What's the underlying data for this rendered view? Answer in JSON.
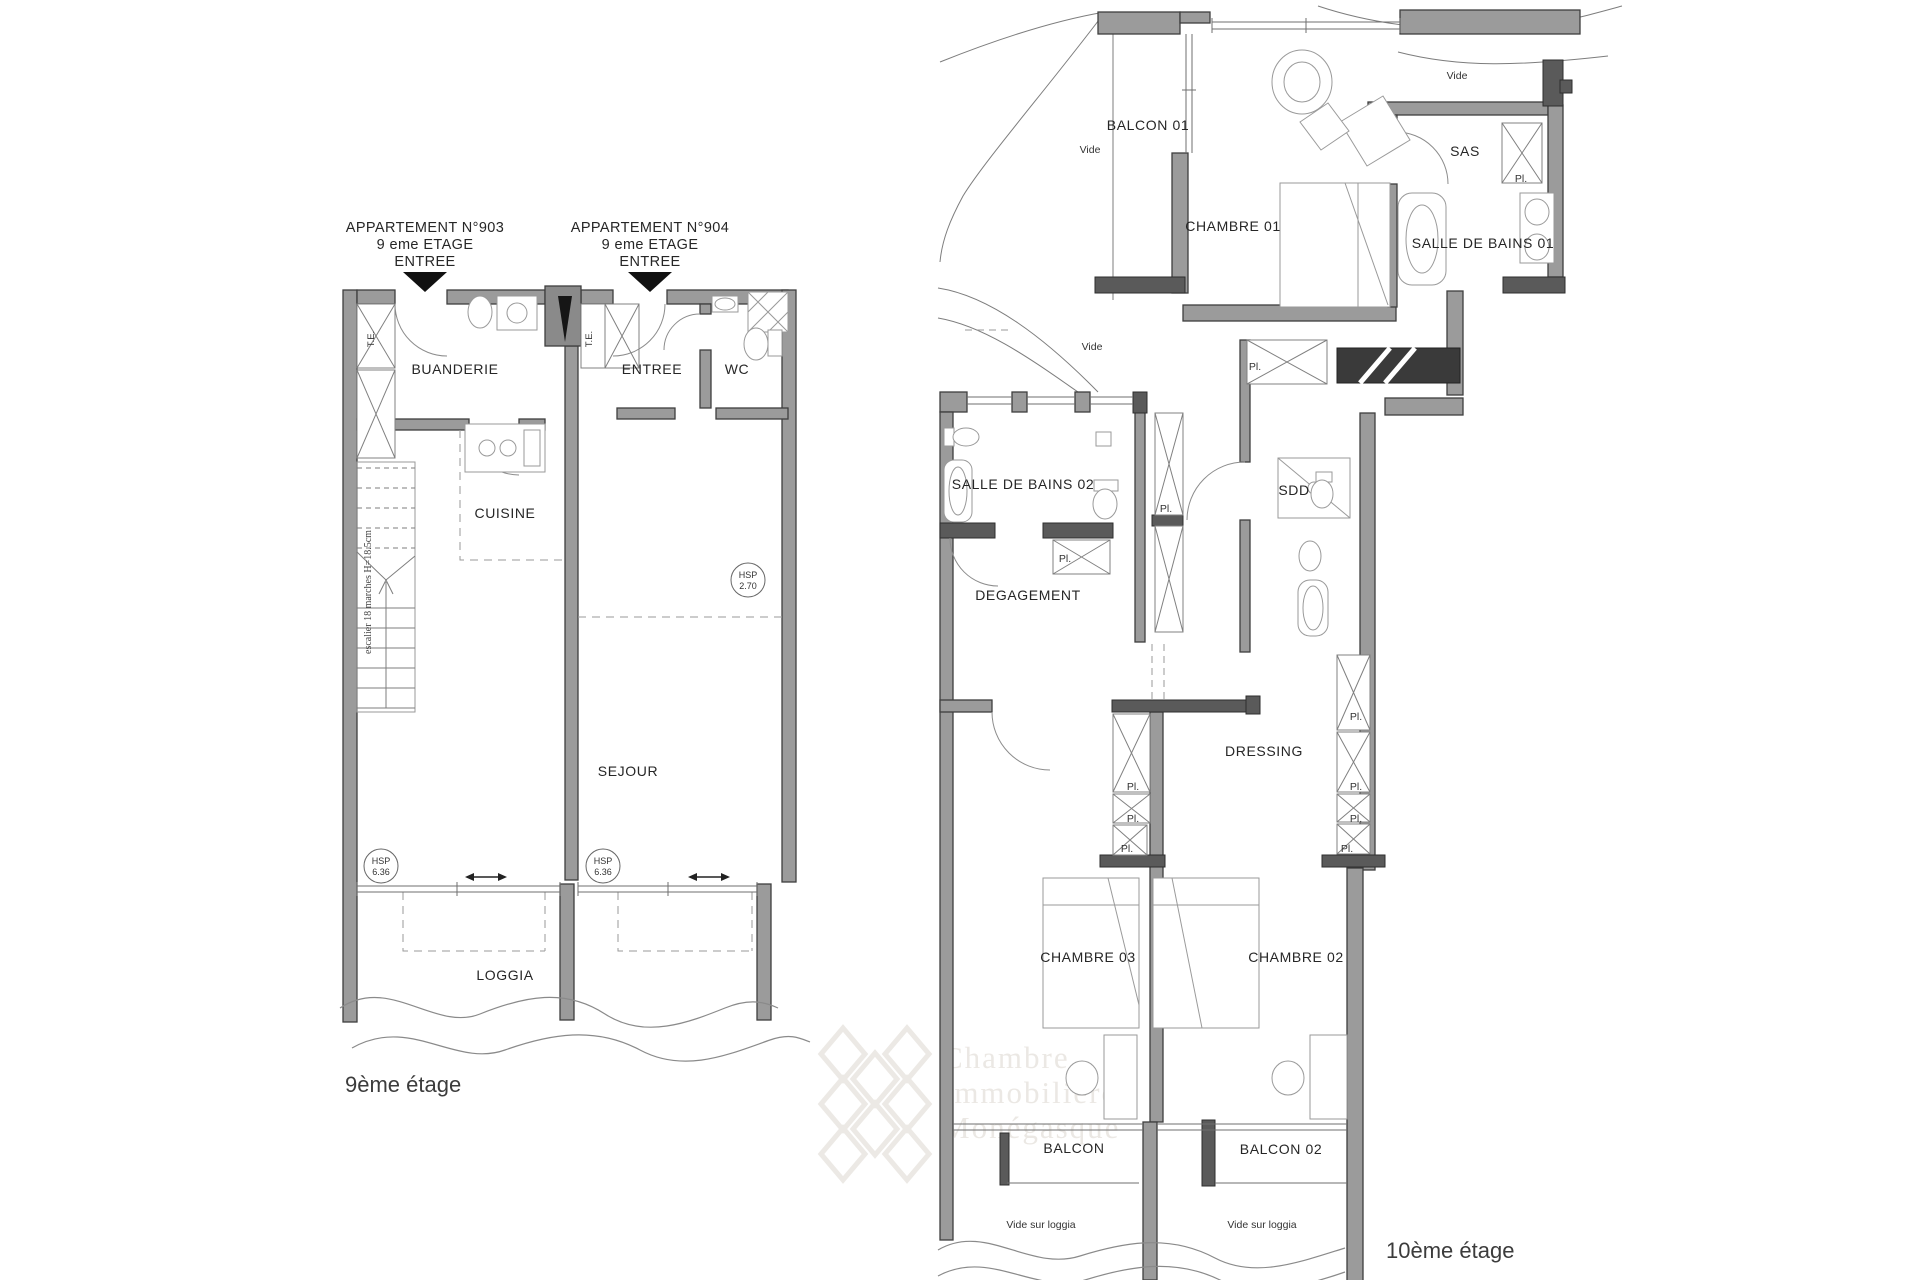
{
  "colors": {
    "wall_gray": "#9b9b9b",
    "wall_dark": "#5a5a5a",
    "wall_black": "#3a3a3a",
    "thin_line": "#777777",
    "text": "#262626",
    "watermark": "#ebe8e4"
  },
  "floor9": {
    "caption": "9ème étage",
    "apt903": {
      "l1": "APPARTEMENT N°903",
      "l2": "9 eme ETAGE",
      "l3": "ENTREE"
    },
    "apt904": {
      "l1": "APPARTEMENT N°904",
      "l2": "9 eme ETAGE",
      "l3": "ENTREE"
    },
    "rooms": {
      "buanderie": "BUANDERIE",
      "entree": "ENTREE",
      "wc": "WC",
      "cuisine": "CUISINE",
      "sejour": "SEJOUR",
      "loggia": "LOGGIA"
    },
    "te": "T.E.",
    "stair_note": "escalier 18 marches H=18.5cm",
    "hsp": "HSP",
    "hsp_270": "2.70",
    "hsp_636": "6.36"
  },
  "floor10": {
    "caption": "10ème étage",
    "rooms": {
      "balcon01": "BALCON 01",
      "chambre01": "CHAMBRE 01",
      "sas": "SAS",
      "sdb01": "SALLE DE BAINS 01",
      "sdb02": "SALLE DE BAINS 02",
      "sdd": "SDD",
      "degagement": "DEGAGEMENT",
      "dressing": "DRESSING",
      "chambre03": "CHAMBRE 03",
      "chambre02": "CHAMBRE 02",
      "balcon": "BALCON",
      "balcon02": "BALCON 02"
    },
    "vide": "Vide",
    "vide_sur_loggia": "Vide sur loggia",
    "pl": "Pl."
  },
  "watermark": {
    "l1": "Chambre",
    "l2": "Immobilière",
    "l3": "Monégasque"
  }
}
